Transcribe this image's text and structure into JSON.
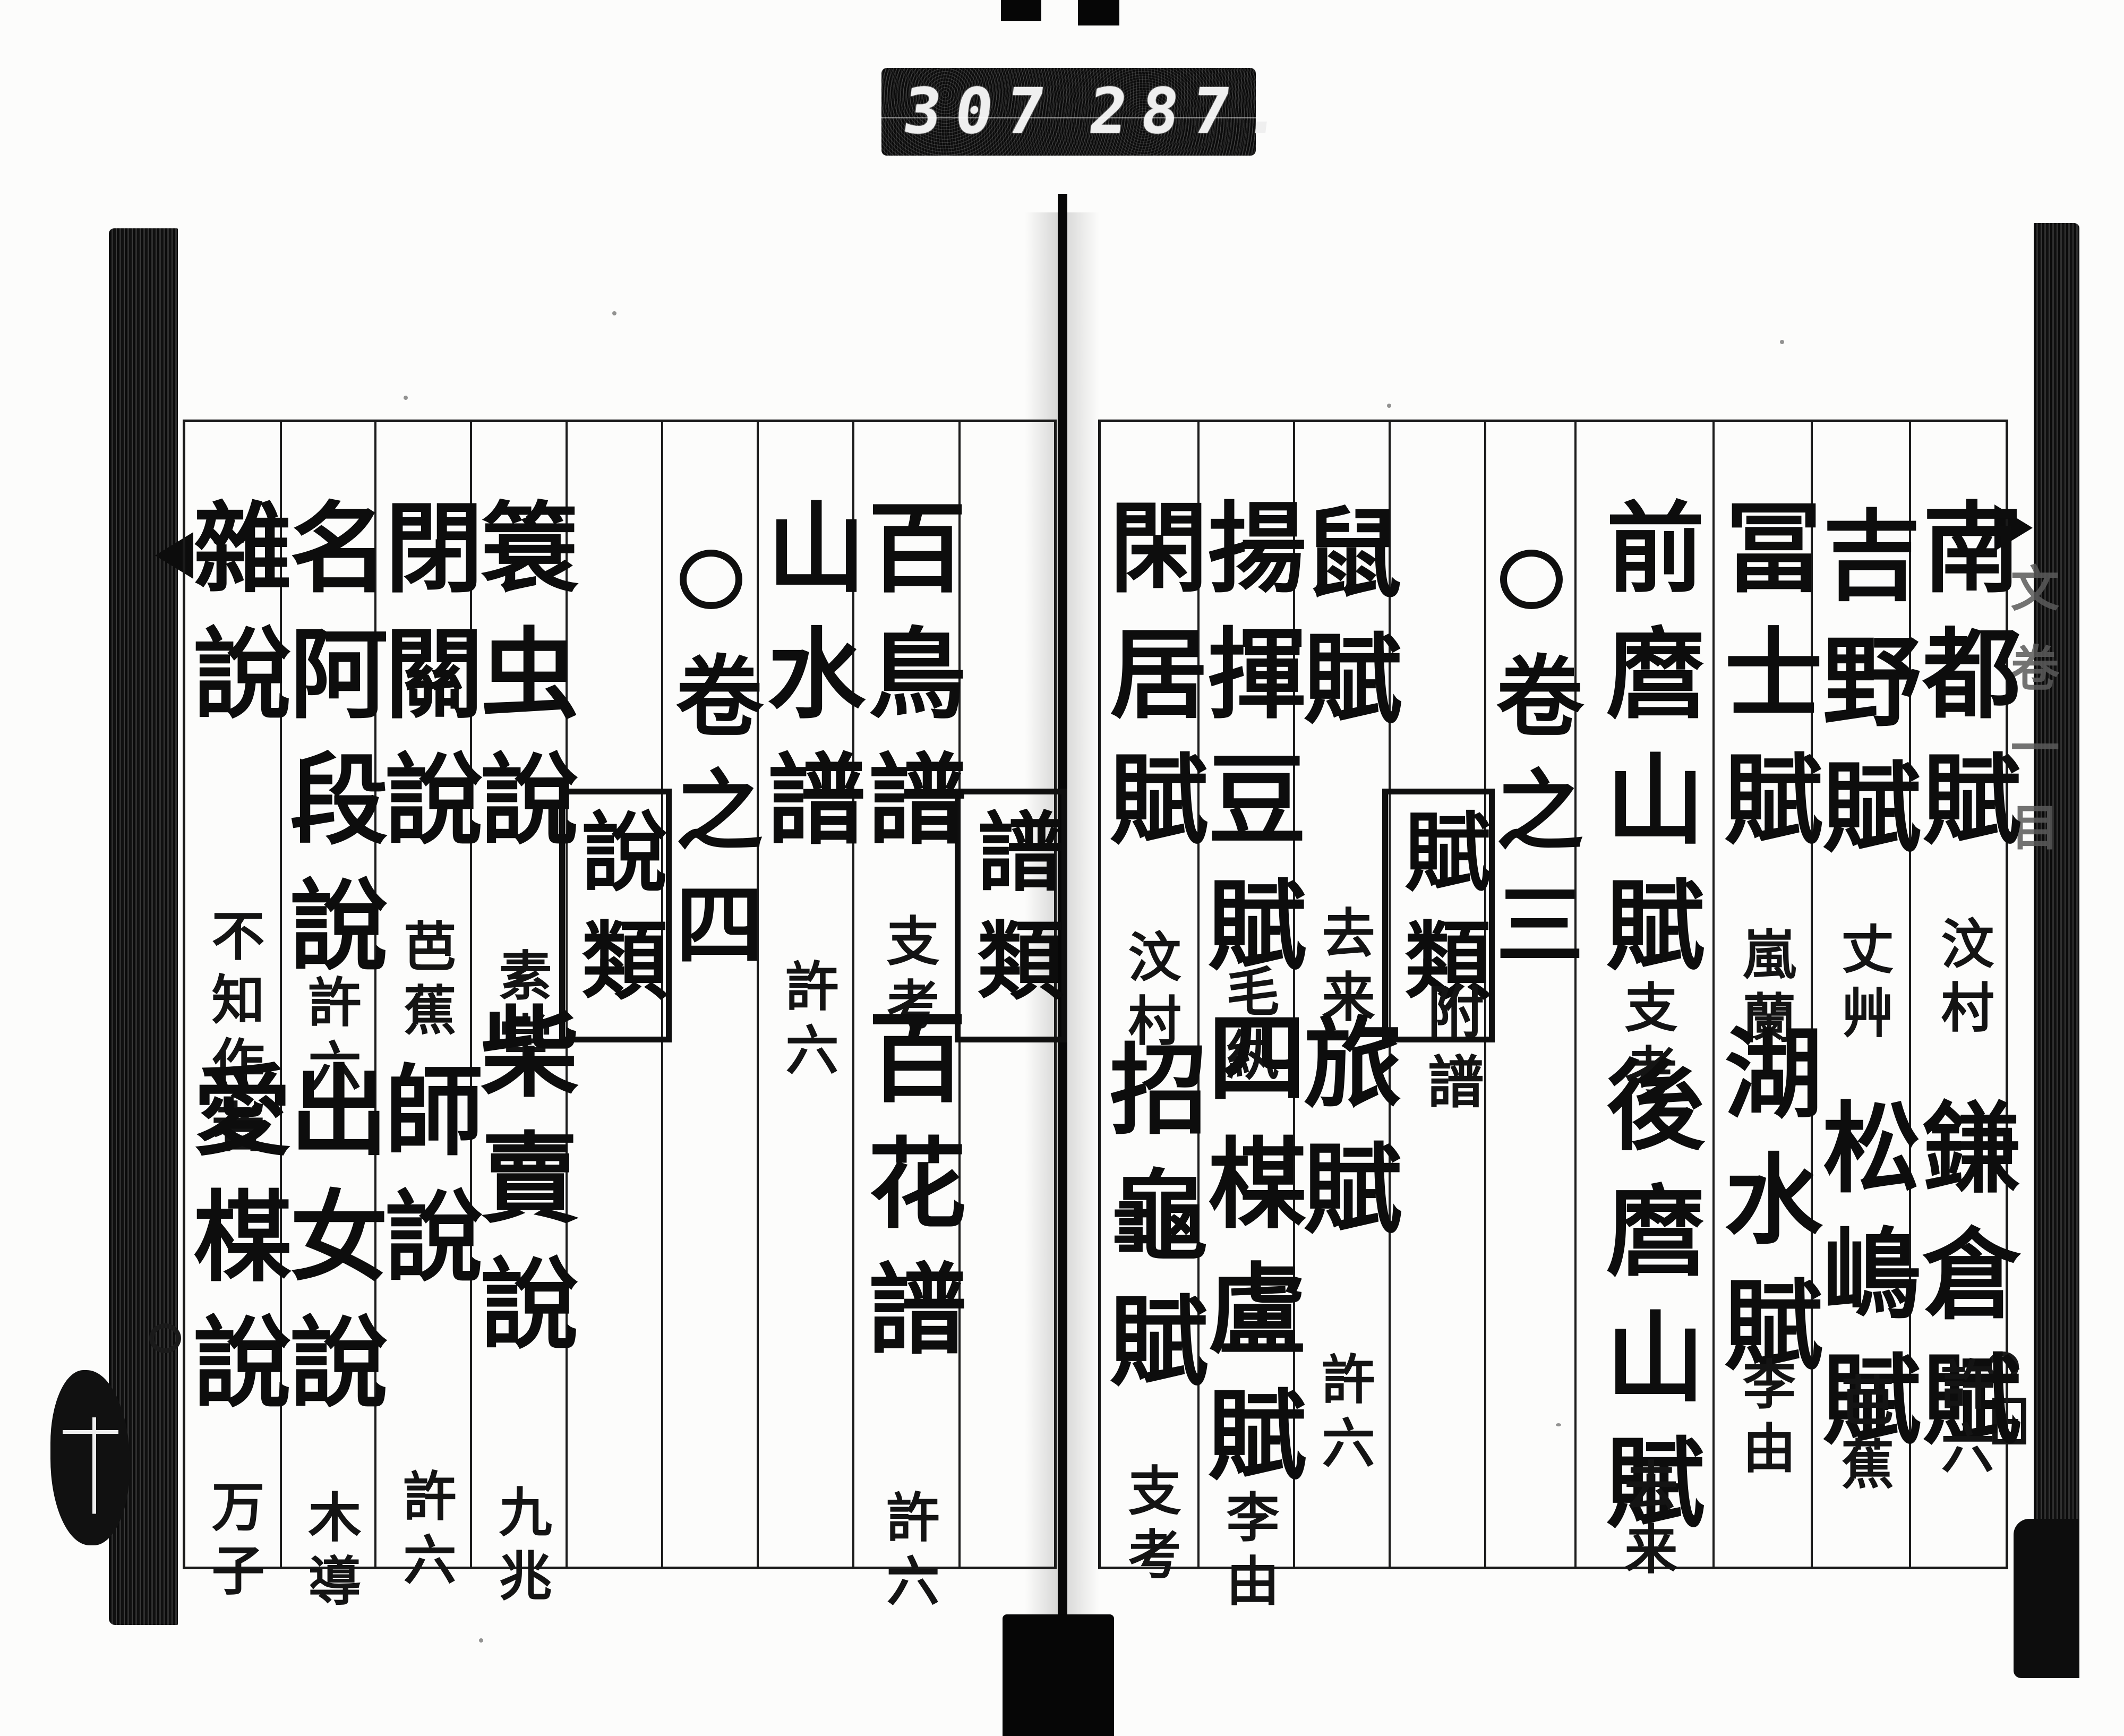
{
  "counter": {
    "left_value": "307",
    "right_value": "287."
  },
  "edges": {
    "right_tab_label": "文卷一目"
  },
  "right_page": {
    "columns": [
      {
        "type": "entries",
        "items": [
          {
            "title": "南都賦",
            "author": "汶村"
          },
          {
            "title": "鎌倉賦",
            "author": "許六"
          }
        ]
      },
      {
        "type": "entries",
        "items": [
          {
            "title": "吉野賦",
            "author": "丈艸"
          },
          {
            "title": "松嶋賦",
            "author": "芭蕉"
          }
        ]
      },
      {
        "type": "entries",
        "items": [
          {
            "title": "冨士賦",
            "author": "嵐蘭"
          },
          {
            "title": "湖水賦",
            "author": "李由"
          }
        ]
      },
      {
        "type": "entries",
        "items": [
          {
            "title": "前麿山賦",
            "author": "支考"
          },
          {
            "title": "後麿山賦",
            "author": "去来"
          }
        ]
      },
      {
        "type": "volume",
        "mark": "○",
        "label": "卷之三"
      },
      {
        "type": "category",
        "label": "賦類",
        "sub": "附譜"
      },
      {
        "type": "entries",
        "items": [
          {
            "title": "鼠賦",
            "author": "去来"
          },
          {
            "title": "旅賦",
            "author": "許六"
          }
        ]
      },
      {
        "type": "entries",
        "items": [
          {
            "title": "揚揮豆賦",
            "author": "毛紈"
          },
          {
            "title": "四楳盧賦",
            "author": "李由"
          }
        ]
      },
      {
        "type": "entries",
        "items": [
          {
            "title": "閑居賦",
            "author": "汶村"
          },
          {
            "title": "招龜賦",
            "author": "支考"
          }
        ]
      }
    ]
  },
  "left_page": {
    "columns": [
      {
        "type": "category",
        "label": "譜類"
      },
      {
        "type": "entries",
        "items": [
          {
            "title": "百鳥譜",
            "author": "支考"
          },
          {
            "title": "百花譜",
            "author": "許六"
          }
        ]
      },
      {
        "type": "entries",
        "items": [
          {
            "title": "山水譜",
            "author": "許六"
          }
        ]
      },
      {
        "type": "volume",
        "mark": "○",
        "label": "卷之四"
      },
      {
        "type": "category",
        "label": "說類"
      },
      {
        "type": "entries",
        "items": [
          {
            "title": "簑虫說",
            "author": "素堂"
          },
          {
            "title": "柴賣說",
            "author": "九兆"
          }
        ]
      },
      {
        "type": "entries",
        "items": [
          {
            "title": "閉關說",
            "author": "芭蕉"
          },
          {
            "title": "師說",
            "author": "許六"
          }
        ]
      },
      {
        "type": "entries",
        "items": [
          {
            "title": "名阿段說",
            "author": "許六"
          },
          {
            "title": "出女說",
            "author": "木導"
          }
        ]
      },
      {
        "type": "entries",
        "items": [
          {
            "title": "雜說",
            "author": "不知作者"
          },
          {
            "title": "愛楳說",
            "author": "万子"
          }
        ]
      }
    ]
  }
}
